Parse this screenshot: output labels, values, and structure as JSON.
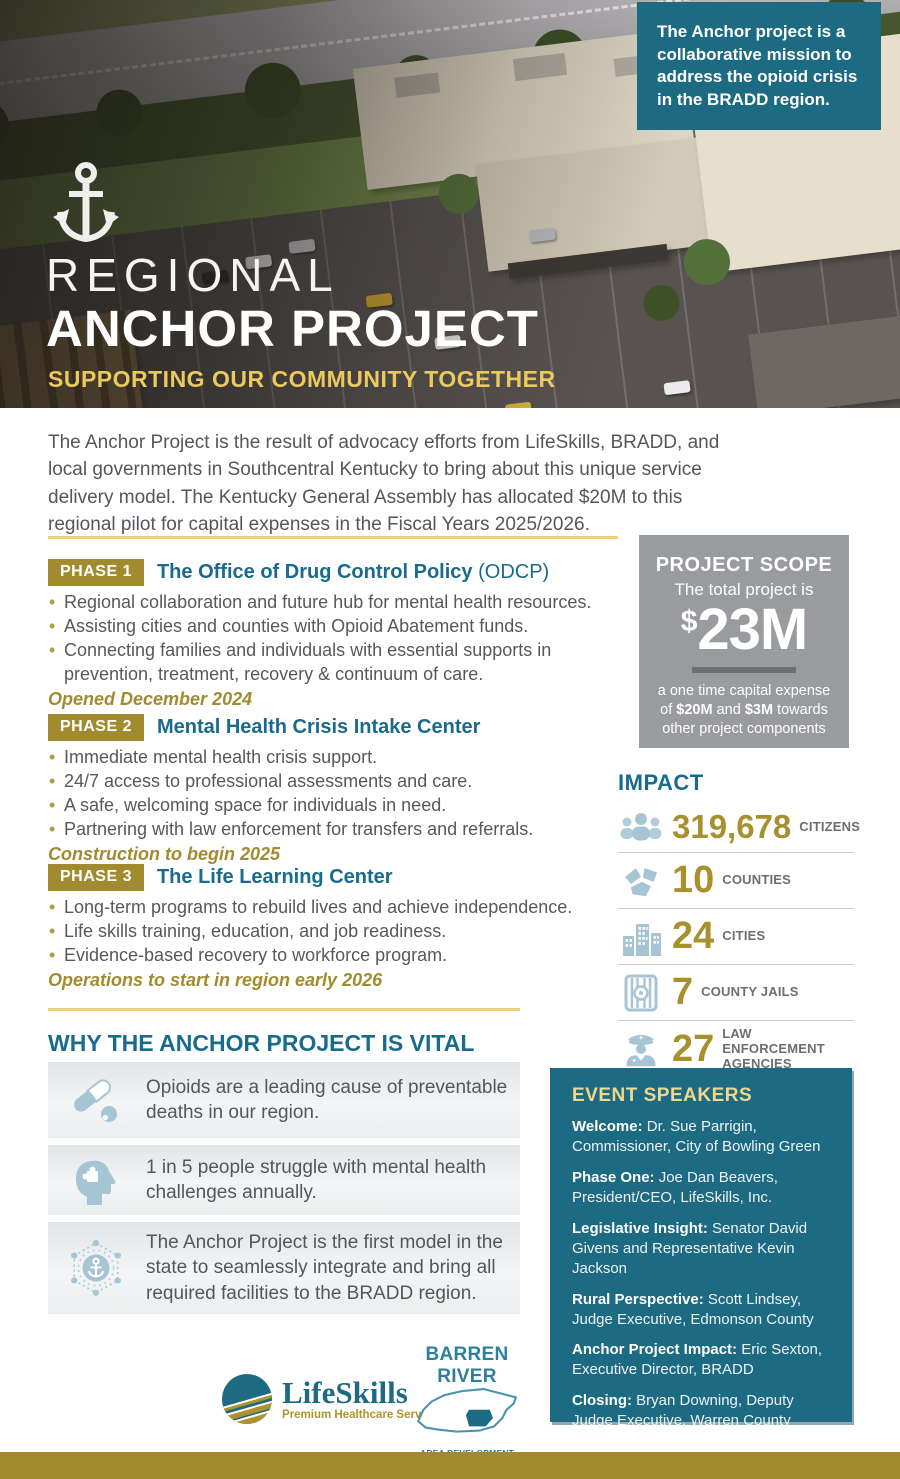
{
  "hero": {
    "callout": "The Anchor project is a collaborative mission to address the opioid crisis in the BRADD region.",
    "title_line1": "REGIONAL",
    "title_line2": "ANCHOR PROJECT",
    "subtitle": "SUPPORTING OUR COMMUNITY TOGETHER"
  },
  "intro": "The Anchor Project is the result of advocacy efforts from LifeSkills, BRADD, and local governments in Southcentral Kentucky to bring about this unique service delivery model. The Kentucky General Assembly has allocated $20M to this regional pilot for capital expenses in the Fiscal Years 2025/2026.",
  "phases": [
    {
      "badge": "PHASE 1",
      "title": "The Office of Drug Control Policy",
      "title_suffix": " (ODCP)",
      "bullets": [
        "Regional collaboration and future hub for mental health resources.",
        "Assisting cities and counties with Opioid Abatement funds.",
        "Connecting families and individuals with essential supports in prevention, treatment, recovery & continuum of care."
      ],
      "status": "Opened December 2024"
    },
    {
      "badge": "PHASE 2",
      "title": "Mental Health Crisis Intake Center",
      "bullets": [
        "Immediate mental health crisis support.",
        "24/7 access to professional assessments and care.",
        "A safe, welcoming space for individuals in need.",
        "Partnering with law enforcement for transfers and referrals."
      ],
      "status": "Construction to begin 2025"
    },
    {
      "badge": "PHASE 3",
      "title": "The Life Learning Center",
      "bullets": [
        "Long-term programs to rebuild lives and achieve independence.",
        "Life skills training, education, and job readiness.",
        "Evidence-based recovery to workforce program."
      ],
      "status": "Operations to start in region early 2026"
    }
  ],
  "project_scope": {
    "title": "PROJECT SCOPE",
    "subtitle": "The total project is",
    "amount_symbol": "$",
    "amount": "23M",
    "note_pre": "a one time capital expense of ",
    "note_bold1": "$20M",
    "note_mid": " and ",
    "note_bold2": "$3M",
    "note_post": " towards other project components"
  },
  "impact": {
    "title": "IMPACT",
    "stats": [
      {
        "icon": "citizens-icon",
        "value": "319,678",
        "label": "CITIZENS"
      },
      {
        "icon": "counties-icon",
        "value": "10",
        "label": "COUNTIES"
      },
      {
        "icon": "cities-icon",
        "value": "24",
        "label": "CITIES"
      },
      {
        "icon": "jail-icon",
        "value": "7",
        "label": "COUNTY JAILS"
      },
      {
        "icon": "police-icon",
        "value": "27",
        "label": "LAW ENFORCEMENT AGENCIES"
      }
    ]
  },
  "vital": {
    "title": "WHY THE ANCHOR PROJECT IS VITAL",
    "cards": [
      {
        "icon": "pill-icon",
        "text": "Opioids are a leading cause of preventable deaths in our region."
      },
      {
        "icon": "mental-health-icon",
        "text": "1 in 5 people struggle with mental health challenges annually."
      },
      {
        "icon": "anchor-network-icon",
        "text": "The Anchor Project is the first model in the state to seamlessly integrate and bring all required facilities to the BRADD region."
      }
    ]
  },
  "speakers": {
    "title": "EVENT SPEAKERS",
    "items": [
      {
        "role": "Welcome:",
        "name": "Dr. Sue Parrigin, Commissioner, City of Bowling Green"
      },
      {
        "role": "Phase One:",
        "name": "Joe Dan Beavers, President/CEO, LifeSkills, Inc."
      },
      {
        "role": "Legislative Insight:",
        "name": "Senator David Givens and Representative Kevin Jackson"
      },
      {
        "role": "Rural Perspective:",
        "name": "Scott Lindsey, Judge Executive, Edmonson County"
      },
      {
        "role": "Anchor Project Impact:",
        "name": "Eric Sexton, Executive Director, BRADD"
      },
      {
        "role": "Closing:",
        "name": "Bryan Downing, Deputy Judge Executive, Warren County"
      }
    ]
  },
  "logos": {
    "lifeskills_name": "LifeSkills",
    "lifeskills_tagline": "Premium Healthcare Services",
    "barren_river_name": "BARREN RIVER",
    "barren_river_tagline": "AREA DEVELOPMENT DISTRICT"
  },
  "colors": {
    "teal": "#1d6a83",
    "teal_heading": "#186b8c",
    "gold": "#a28b2f",
    "gold_number": "#a8902f",
    "light_gold_rule": "#ead27a",
    "hero_subtitle_gold": "#eac95e",
    "gray_box": "#9a9b9f",
    "body_text": "#57585b",
    "icon_blue": "#a5c4d4",
    "footer_gold": "#a38b2d"
  }
}
